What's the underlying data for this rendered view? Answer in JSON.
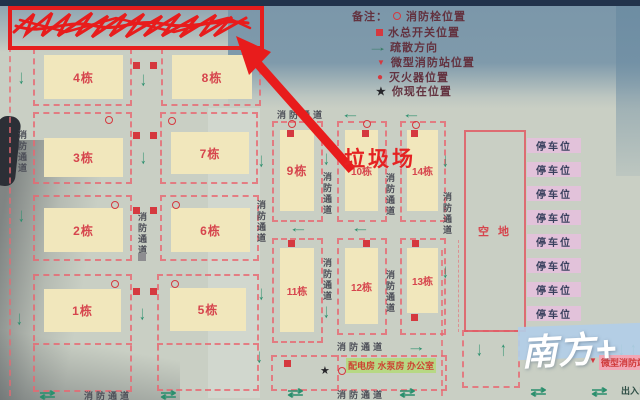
{
  "legend": {
    "prefix": "备注：",
    "items": [
      {
        "icon": "hydrant-circle",
        "label": "消防栓位置"
      },
      {
        "icon": "water-valve-square",
        "label": "水总开关位置"
      },
      {
        "icon": "evacuation-arrow",
        "label": "疏散方向"
      },
      {
        "icon": "mini-station-triangle",
        "label": "微型消防站位置"
      },
      {
        "icon": "extinguisher-dot",
        "label": "灭火器位置"
      },
      {
        "icon": "you-are-here-star",
        "label": "你现在位置"
      }
    ]
  },
  "buildings": {
    "b1": "1栋",
    "b2": "2栋",
    "b3": "3栋",
    "b4": "4栋",
    "b5": "5栋",
    "b6": "6栋",
    "b7": "7栋",
    "b8": "8栋",
    "b9": "9栋",
    "b10": "10栋",
    "b11": "11栋",
    "b12": "12栋",
    "b13": "13栋",
    "b14": "14栋"
  },
  "labels": {
    "fire_lane": "消防通道",
    "empty_lot": "空 地",
    "parking_space": "停车位",
    "facilities": "配电房 水泵房 办公室",
    "mini_fire_station": "微型消防站",
    "entrance_exit": "出入口",
    "garbage_site": "垃圾场",
    "watermark": "南方+"
  },
  "icons": {
    "down": "↓",
    "up": "↑",
    "left": "←",
    "right": "→",
    "swap": "⇄",
    "star": "★",
    "triangle": "▼",
    "dot": "●"
  },
  "colors": {
    "plot_border": "#e96771",
    "building_fill": "#f1e7bc",
    "building_label": "#d6454d",
    "green_arrow": "#2a8f6d",
    "red_marker": "#d5393f",
    "annotation_red": "#e81c1c",
    "parking_bg": "#e2c2da",
    "facility_bg": "#b7d884",
    "station_bg": "#f2a7b5",
    "reflection_blue": "#7b97aa",
    "watermark_band": "#b2cee7"
  }
}
